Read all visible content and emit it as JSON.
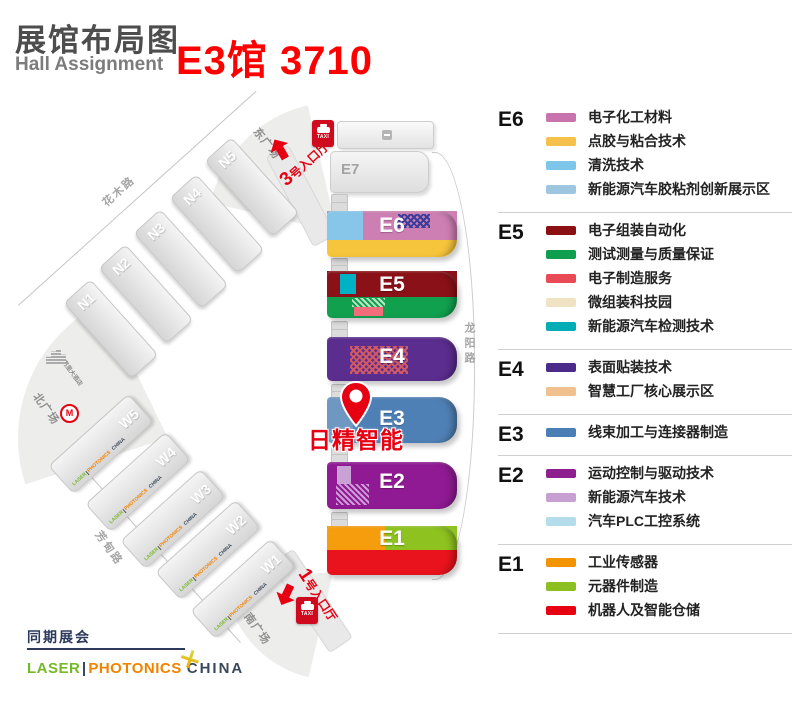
{
  "header": {
    "title": "展馆布局图",
    "subtitle": "Hall Assignment",
    "booth": "E3馆 3710"
  },
  "map": {
    "pin_label": "日精智能",
    "taxi_label": "TAXI",
    "hotel_label": "嘉里大酒店",
    "roads": {
      "north": "花木路",
      "west": "芳甸路",
      "east": "龙阳路"
    },
    "squares": {
      "east": "东广场",
      "north": "北广场",
      "south": "南广场"
    },
    "entrances": {
      "gate3": {
        "num": "3",
        "label": "号入口厅"
      },
      "gate1": {
        "num": "1",
        "label": "号入口厅"
      }
    },
    "halls": {
      "e7": "E7",
      "e6": "E6",
      "e5": "E5",
      "e4": "E4",
      "e3": "E3",
      "e2": "E2",
      "e1": "E1",
      "n": [
        "N1",
        "N2",
        "N3",
        "N4",
        "N5"
      ],
      "w": [
        "W1",
        "W2",
        "W3",
        "W4",
        "W5"
      ]
    }
  },
  "brand": {
    "laser": "LASER",
    "photonics": "PHOTONICS",
    "china": "CHINA"
  },
  "legend": {
    "sections": [
      {
        "id": "E6",
        "items": [
          {
            "label": "电子化工材料",
            "color": "#c873ae"
          },
          {
            "label": "点胶与粘合技术",
            "color": "#f6c14a"
          },
          {
            "label": "清洗技术",
            "color": "#7ec5ea"
          },
          {
            "label": "新能源汽车胶粘剂创新展示区",
            "color": "#9fc6e0",
            "hatch": true
          }
        ]
      },
      {
        "id": "E5",
        "items": [
          {
            "label": "电子组装自动化",
            "color": "#8b1014"
          },
          {
            "label": "测试测量与质量保证",
            "color": "#0f9d4f"
          },
          {
            "label": "电子制造服务",
            "color": "#e84a56"
          },
          {
            "label": "微组装科技园",
            "color": "#efe3c3",
            "hatch": true
          },
          {
            "label": "新能源汽车检测技术",
            "color": "#00adb5"
          }
        ]
      },
      {
        "id": "E4",
        "items": [
          {
            "label": "表面贴装技术",
            "color": "#4b2a8a"
          },
          {
            "label": "智慧工厂核心展示区",
            "color": "#f0c08e",
            "hatch": true
          }
        ]
      },
      {
        "id": "E3",
        "items": [
          {
            "label": "线束加工与连接器制造",
            "color": "#4a7eb5"
          }
        ]
      },
      {
        "id": "E2",
        "items": [
          {
            "label": "运动控制与驱动技术",
            "color": "#8e1f8e"
          },
          {
            "label": "新能源汽车技术",
            "color": "#c79fd1"
          },
          {
            "label": "汽车PLC工控系统",
            "color": "#b5dcea",
            "hatch": true
          }
        ]
      },
      {
        "id": "E1",
        "items": [
          {
            "label": "工业传感器",
            "color": "#f29400"
          },
          {
            "label": "元器件制造",
            "color": "#8cc021"
          },
          {
            "label": "机器人及智能仓储",
            "color": "#e60012"
          }
        ]
      }
    ]
  },
  "footer": {
    "concurrent": "同期展会"
  },
  "colors": {
    "booth_red": "#fe0000",
    "entry_red": "#e60012",
    "e6_blue": "#87c6e9",
    "e6_pink": "#cd7fb3",
    "e6_yellow": "#f7c53c",
    "e6_hatch": "#3c3c9a",
    "e5_dark_red": "#8a1117",
    "e5_teal": "#00b3c4",
    "e5_green": "#10a04e",
    "e5_hatch": "#b9e7c6",
    "e5_rose": "#f26d7b",
    "e4_purple": "#5b2d8f",
    "e4_hatch": "#d05a64",
    "e3_blue": "#4f80b5",
    "e2_magenta": "#8f1a93",
    "e2_lilac": "#c9a1d5",
    "e2_hatch": "#cf9ed9",
    "e1_orange": "#f59d0c",
    "e1_lime": "#8dc220",
    "e1_red": "#e8131c",
    "brand_green": "#76b82a",
    "brand_orange": "#f08300",
    "brand_dark": "#3b4a5a",
    "footer_navy": "#2c3a5c"
  }
}
